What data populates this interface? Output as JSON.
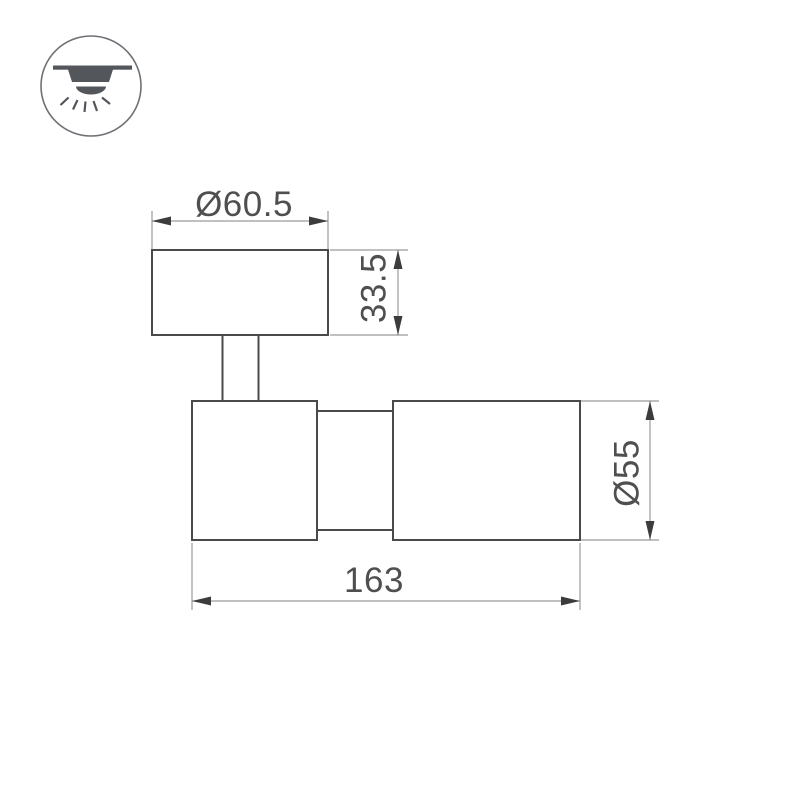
{
  "page": {
    "background_color": "#ffffff"
  },
  "mount_icon": {
    "meaning": "surface-mounted-ceiling-light",
    "circle_color": "#6e7276",
    "glyph_color": "#53575c"
  },
  "drawing": {
    "colors": {
      "outline": "#4a4a4a",
      "dim_line": "#9b9b9b",
      "arrow": "#3c3c3c",
      "text": "#4f4f4f"
    },
    "dimensions": {
      "base_diameter": "Ø60.5",
      "base_height": "33.5",
      "head_diameter": "Ø55",
      "overall_length": "163"
    }
  }
}
